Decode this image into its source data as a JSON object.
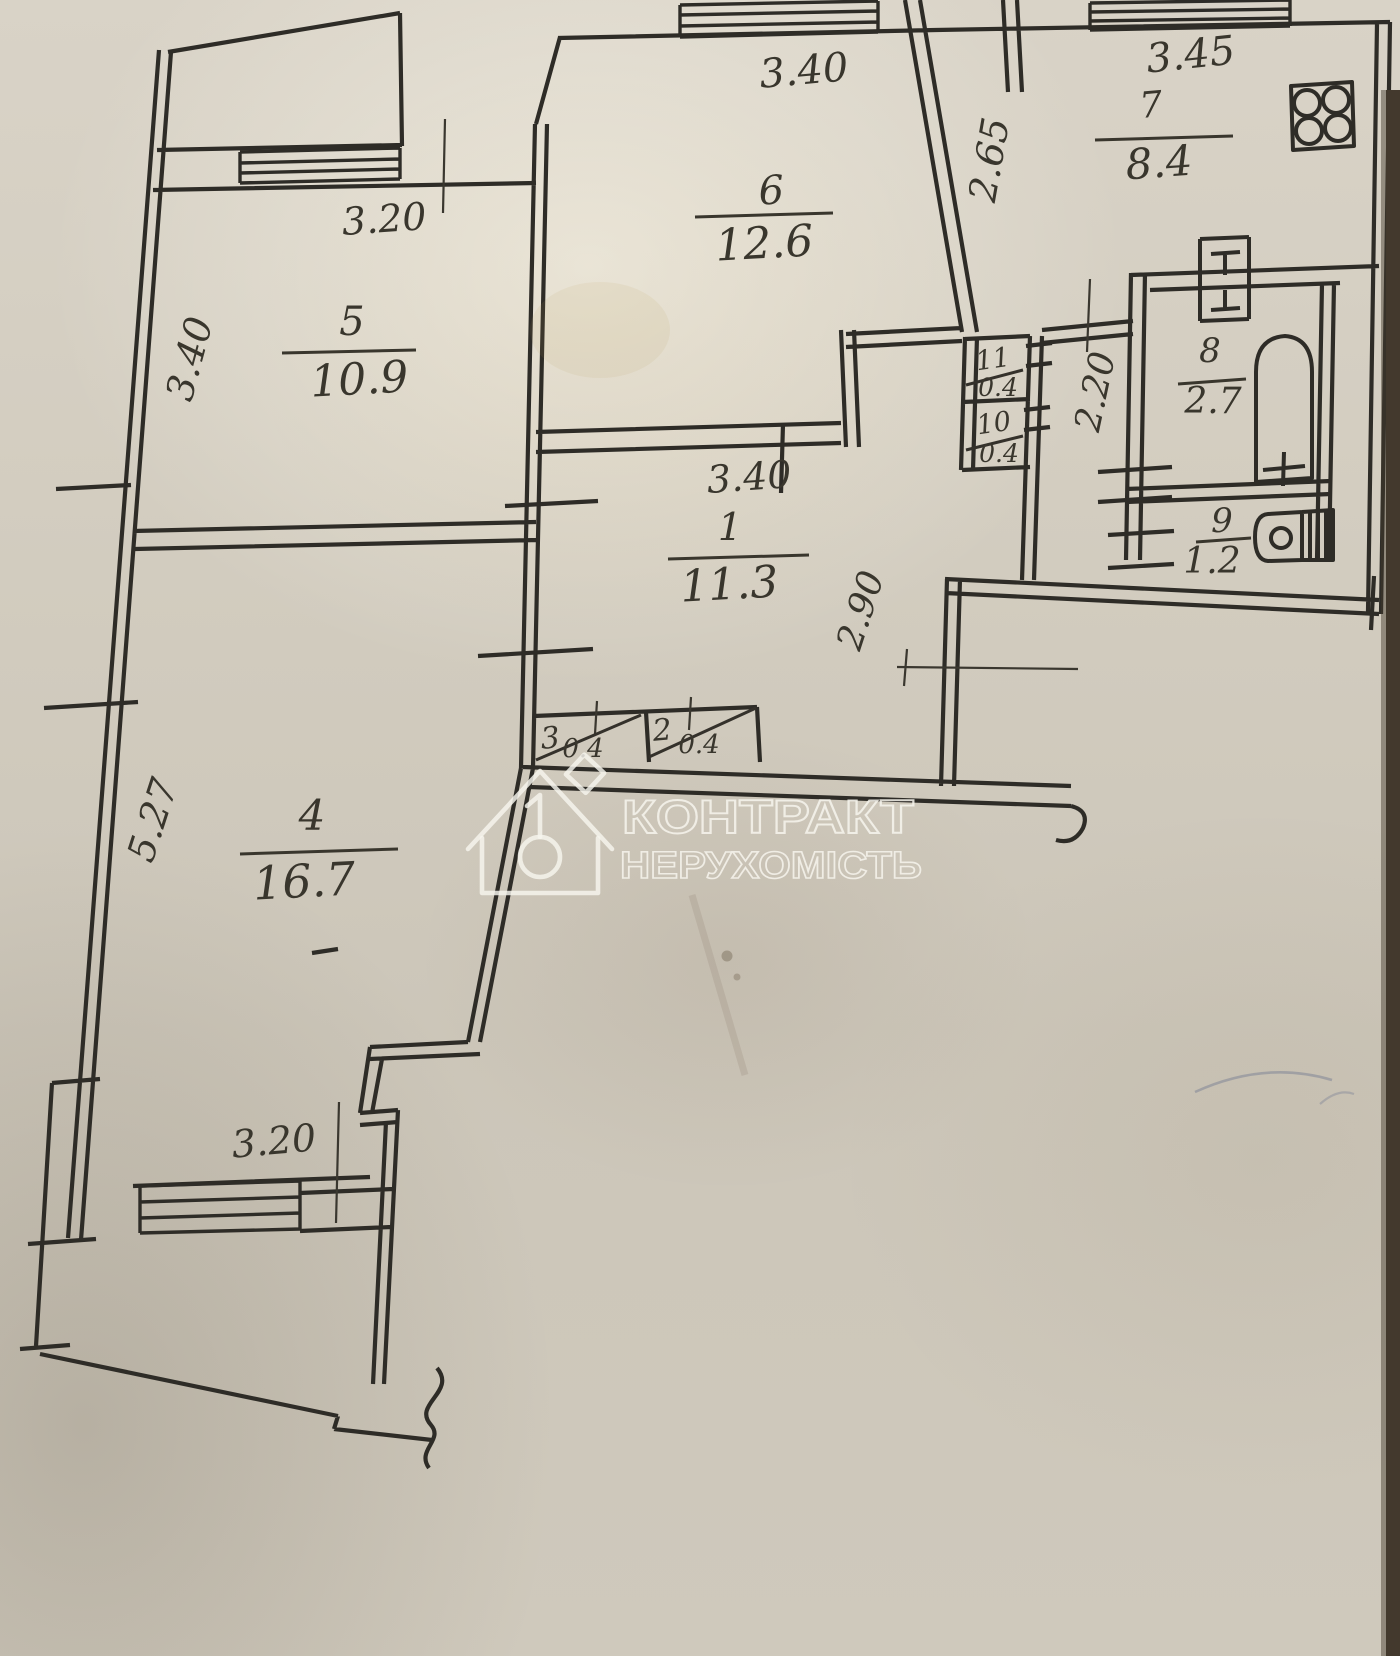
{
  "page": {
    "kind": "apartment floor plan photo",
    "ink_color": "#2e2c27",
    "paper_color": "#d2ccbf"
  },
  "watermark": {
    "line1": "КОНТРАКТ",
    "line2": "НЕРУХОМІСТЬ",
    "icon": "house-key-icon"
  },
  "rooms": {
    "r1": {
      "number": "1",
      "area": "11.3"
    },
    "r2": {
      "number": "2",
      "area": "0.4"
    },
    "r3": {
      "number": "3",
      "area": "0.4"
    },
    "r4": {
      "number": "4",
      "area": "16.7"
    },
    "r5": {
      "number": "5",
      "area": "10.9"
    },
    "r6": {
      "number": "6",
      "area": "12.6"
    },
    "r7": {
      "number": "7",
      "area": "8.4"
    },
    "r8": {
      "number": "8",
      "area": "2.7"
    },
    "r9": {
      "number": "9",
      "area": "1.2"
    },
    "r10": {
      "number": "10",
      "area": "0.4"
    },
    "r11": {
      "number": "11",
      "area": "0.4"
    }
  },
  "dims": {
    "room6_top": "3.40",
    "room7_top": "3.45",
    "kitchen_side": "2.65",
    "room5_top": "3.20",
    "room5_side": "3.40",
    "hall_top": "3.40",
    "bath_side": "2.20",
    "entry_side": "2.90",
    "room4_side": "5.27",
    "room4_bottom": "3.20"
  },
  "fixtures": [
    "stove-icon",
    "vent-icon",
    "bathtub-icon",
    "toilet-icon"
  ]
}
